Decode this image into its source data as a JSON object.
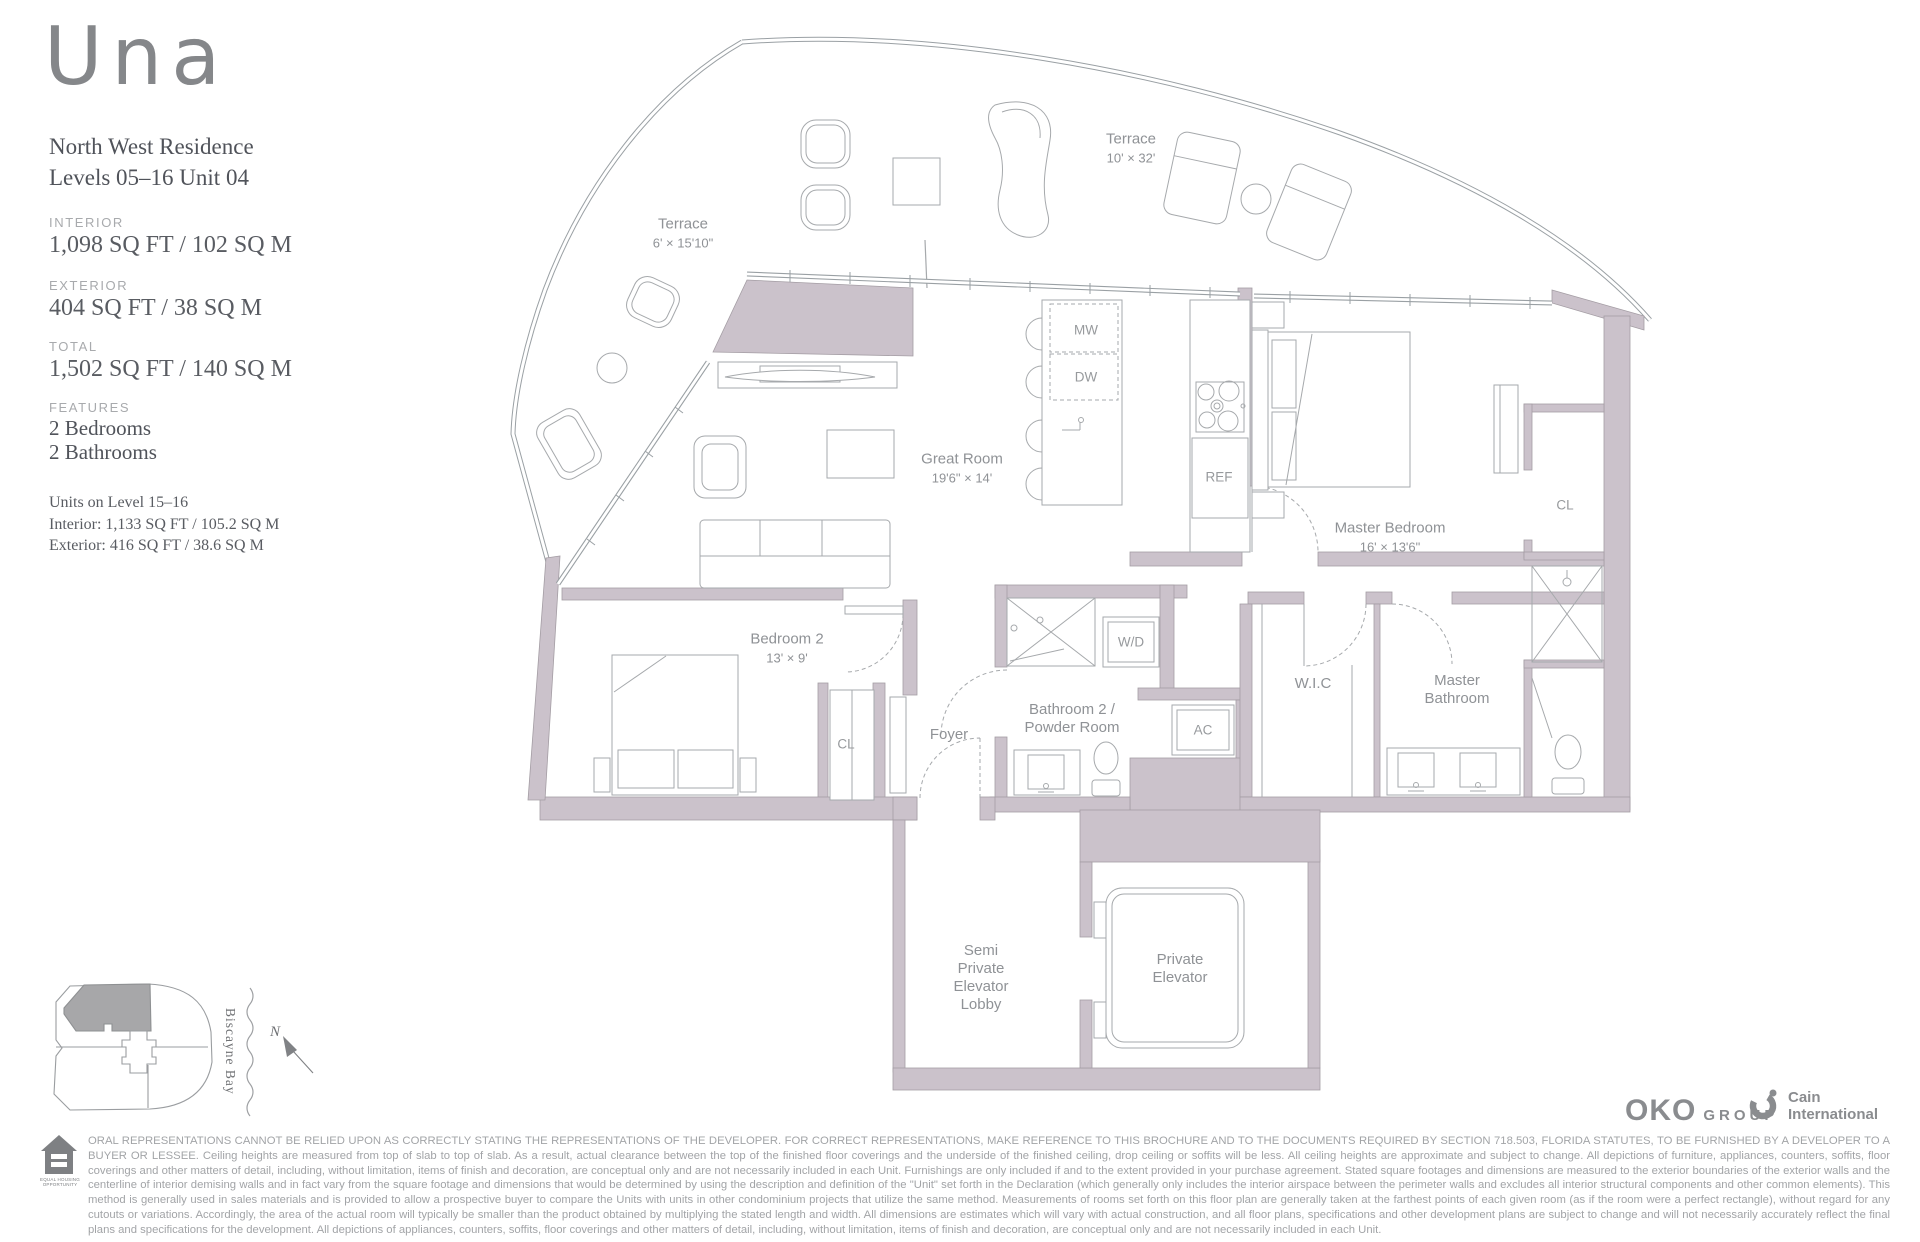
{
  "sidebar": {
    "brand": "Una",
    "residence_line1": "North West Residence",
    "residence_line2": "Levels 05–16 Unit 04",
    "stats": {
      "interior_label": "INTERIOR",
      "interior_value": "1,098 SQ FT / 102 SQ M",
      "exterior_label": "EXTERIOR",
      "exterior_value": "404 SQ FT / 38 SQ M",
      "total_label": "TOTAL",
      "total_value": "1,502 SQ FT / 140 SQ M"
    },
    "features_label": "FEATURES",
    "feature_1": "2 Bedrooms",
    "feature_2": "2 Bathrooms",
    "note_title": "Units on Level 15–16",
    "note_interior": "Interior: 1,133 SQ FT / 105.2 SQ M",
    "note_exterior": "Exterior: 416 SQ FT / 38.6 SQ M"
  },
  "floorplan": {
    "labels": {
      "terrace_left": {
        "name": "Terrace",
        "dims": "6' × 15'10\""
      },
      "terrace_right": {
        "name": "Terrace",
        "dims": "10' × 32'"
      },
      "great_room": {
        "name": "Great Room",
        "dims": "19'6\" × 14'"
      },
      "master_bedroom": {
        "name": "Master Bedroom",
        "dims": "16' × 13'6\""
      },
      "bedroom_2": {
        "name": "Bedroom 2",
        "dims": "13' × 9'"
      },
      "foyer": {
        "name": "Foyer"
      },
      "bathroom_2": {
        "line1": "Bathroom 2 /",
        "line2": "Powder Room"
      },
      "master_bathroom": {
        "line1": "Master",
        "line2": "Bathroom"
      },
      "wic": {
        "name": "W.I.C"
      },
      "cl_bedroom_2": {
        "name": "CL"
      },
      "cl_master": {
        "name": "CL"
      },
      "washer_dryer": {
        "name": "W/D"
      },
      "ac": {
        "name": "AC"
      },
      "microwave": {
        "name": "MW"
      },
      "dishwasher": {
        "name": "DW"
      },
      "refrigerator": {
        "name": "REF"
      },
      "semi_private_lobby": {
        "line1": "Semi",
        "line2": "Private",
        "line3": "Elevator",
        "line4": "Lobby"
      },
      "private_elevator": {
        "line1": "Private",
        "line2": "Elevator"
      }
    }
  },
  "siteplan": {
    "water": "Biscayne Bay",
    "north": "N"
  },
  "footer": {
    "oko_text": "OKO",
    "oko_suffix": "GROUP",
    "cain_line1": "Cain",
    "cain_line2": "International",
    "equal_housing_caption": "EQUAL HOUSING OPPORTUNITY",
    "disclaimer": "ORAL REPRESENTATIONS CANNOT BE RELIED UPON AS CORRECTLY STATING THE REPRESENTATIONS OF THE DEVELOPER. FOR CORRECT REPRESENTATIONS, MAKE REFERENCE TO THIS BROCHURE AND TO THE DOCUMENTS REQUIRED BY SECTION 718.503, FLORIDA STATUTES, TO BE FURNISHED BY A DEVELOPER TO A BUYER OR LESSEE. Ceiling heights are measured from top of slab to top of slab. As a result, actual clearance between the top of the finished floor coverings and the underside of the finished ceiling, drop ceiling or soffits will be less. All ceiling heights are approximate and subject to change. All depictions of furniture, appliances, counters, soffits, floor coverings and other matters of detail, including, without limitation, items of finish and decoration, are conceptual only and are not necessarily included in each Unit. Furnishings are only included if and to the extent provided in your purchase agreement. Stated square footages and dimensions are measured to the exterior boundaries of the exterior walls and the centerline of interior demising walls and in fact vary from the square footage and dimensions that would be determined by using the description and definition of the \"Unit\" set forth in the Declaration (which generally only includes the interior airspace between the perimeter walls and excludes all interior structural components and other common elements). This method is generally used in sales materials and is provided to allow a prospective buyer to compare the Units with units in other condominium projects that utilize the same method. Measurements of rooms set forth on this floor plan are generally taken at the farthest points of each given room (as if the room were a perfect rectangle), without regard for any cutouts or variations. Accordingly, the area of the actual room will typically be smaller than the product obtained by multiplying the stated length and width. All dimensions are estimates which will vary with actual construction, and all floor plans, specifications and other development plans are subject to change and will not necessarily accurately reflect the final plans and specifications for the development. All depictions of appliances, counters, soffits, floor coverings and other matters of detail, including, without limitation, items of finish and decoration, are conceptual only and are not necessarily included in each Unit."
  },
  "colors": {
    "wall_fill": "#cbc2cb",
    "plan_line": "#a6a9ac",
    "label_text": "#8f9296",
    "logo_gray": "#8a8c8f"
  }
}
